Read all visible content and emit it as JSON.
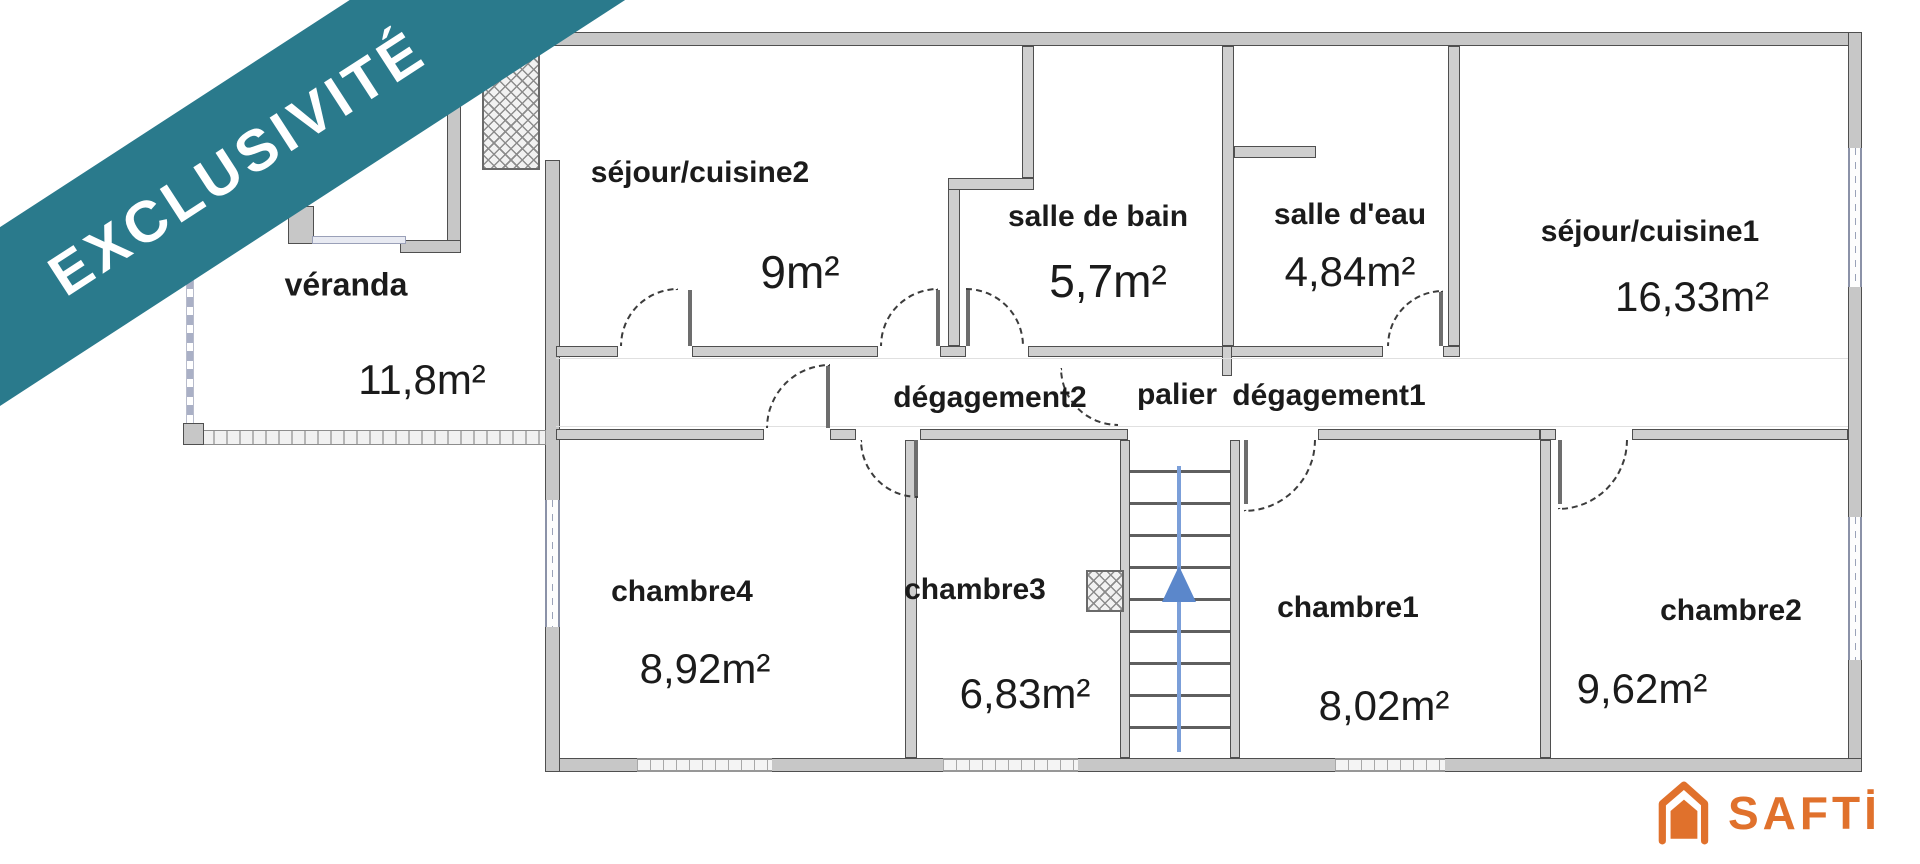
{
  "banner": {
    "label": "EXCLUSIVITÉ",
    "color": "#2a7a8c"
  },
  "rooms": {
    "veranda": {
      "name": "véranda",
      "area": "11,8m²"
    },
    "sejour_cuisine2": {
      "name": "séjour/cuisine2",
      "area": "9m²"
    },
    "salle_de_bain": {
      "name": "salle de bain",
      "area": "5,7m²"
    },
    "salle_deau": {
      "name": "salle d'eau",
      "area": "4,84m²"
    },
    "sejour_cuisine1": {
      "name": "séjour/cuisine1",
      "area": "16,33m²"
    },
    "degagement2": {
      "name": "dégagement2"
    },
    "palier": {
      "name": "palier"
    },
    "degagement1": {
      "name": "dégagement1"
    },
    "chambre4": {
      "name": "chambre4",
      "area": "8,92m²"
    },
    "chambre3": {
      "name": "chambre3",
      "area": "6,83m²"
    },
    "chambre1": {
      "name": "chambre1",
      "area": "8,02m²"
    },
    "chambre2": {
      "name": "chambre2",
      "area": "9,62m²"
    }
  },
  "stairs": {
    "direction_icon": "up-arrow-icon",
    "arrow_color": "#5b87cb"
  },
  "logo": {
    "brand": "SAFTİ",
    "house_icon": "house-icon",
    "color": "#e0712c"
  }
}
